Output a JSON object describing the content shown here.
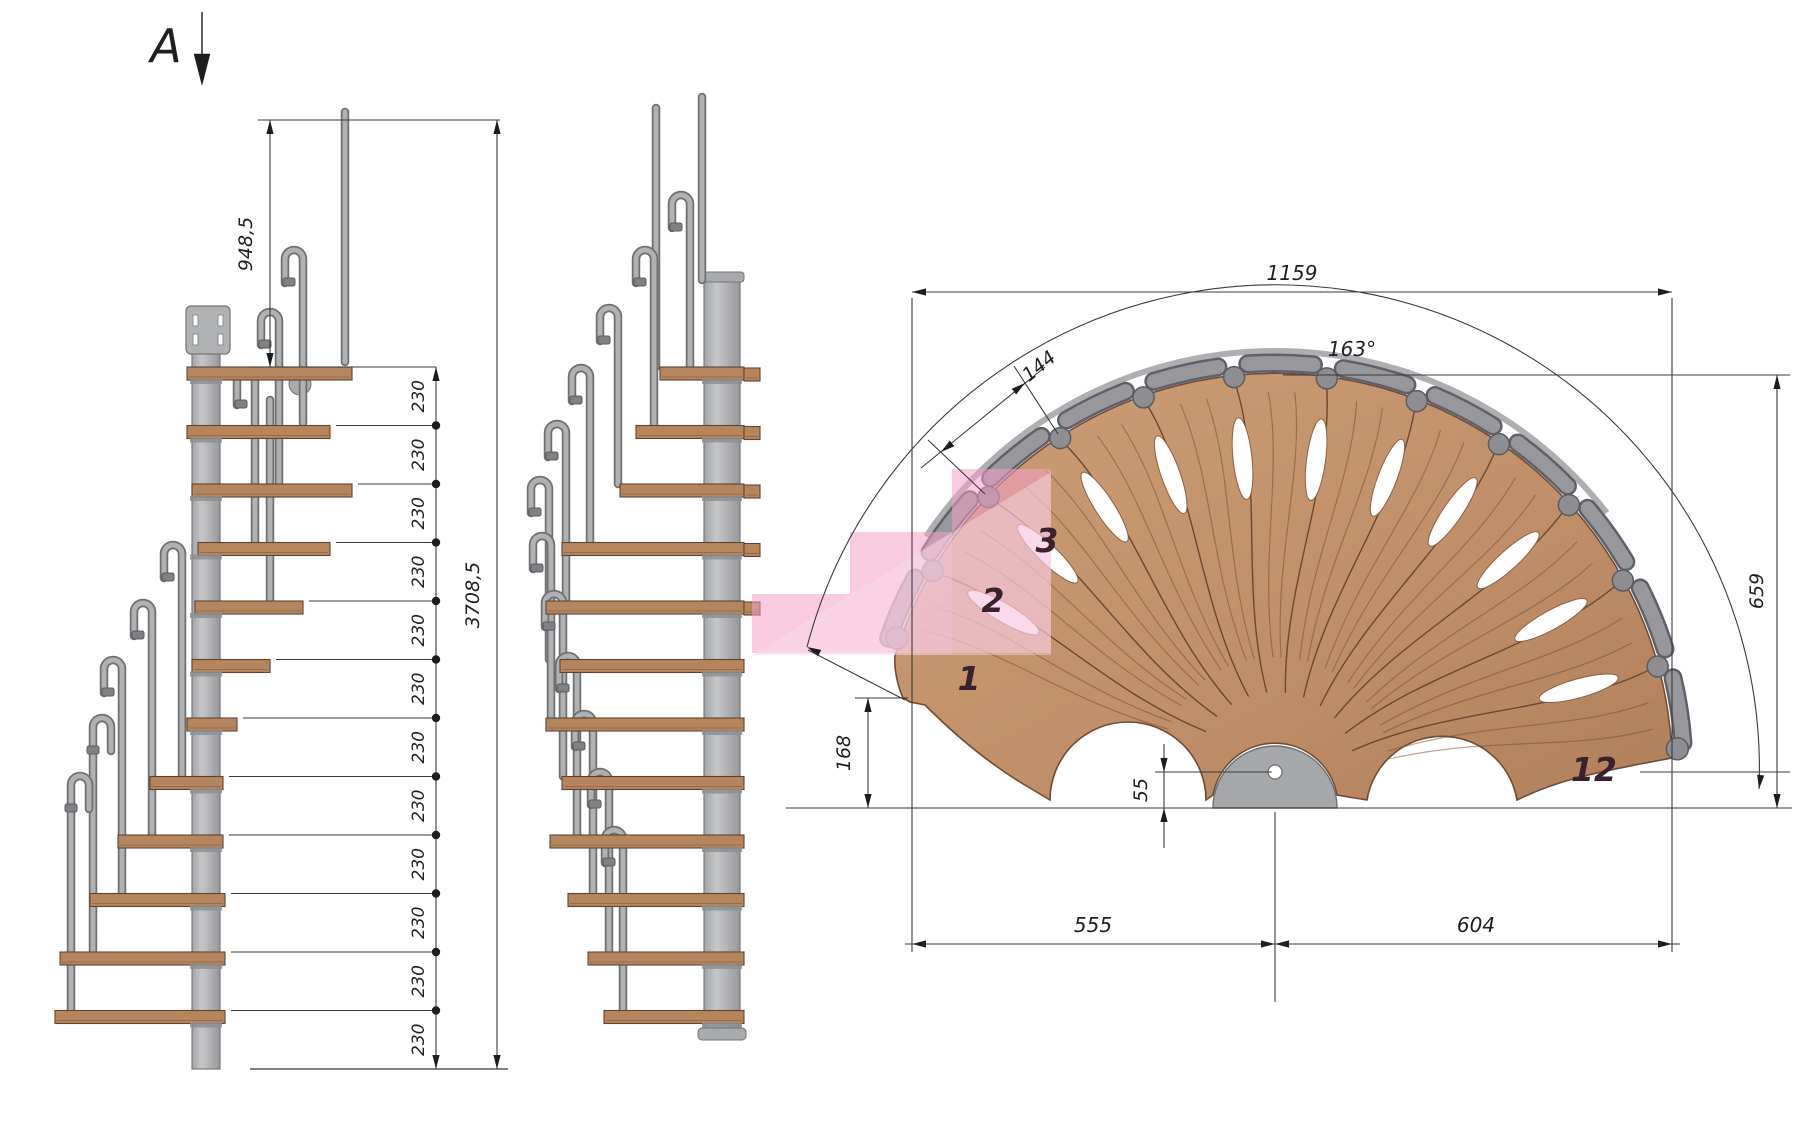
{
  "section_marker": {
    "label": "A"
  },
  "elevation_dims": {
    "top_riser_height": "948,5",
    "riser_height": "230",
    "riser_count": 12,
    "total_height": "3708,5"
  },
  "plan_dims": {
    "overall_width": "1159",
    "rotation_angle": "163°",
    "tread_outer_width": "144",
    "outer_depth": "659",
    "front_offset": "168",
    "column_axis_offset": "55",
    "left_of_axis": "555",
    "right_of_axis": "604"
  },
  "tread_numbers": {
    "first": "1",
    "second": "2",
    "third": "3",
    "last": "12"
  },
  "colors": {
    "wood": "#c1906a",
    "metal": "#b4b5b7",
    "overlay_pink": "#f2a0c8",
    "dim_line": "#3b3b3b"
  }
}
